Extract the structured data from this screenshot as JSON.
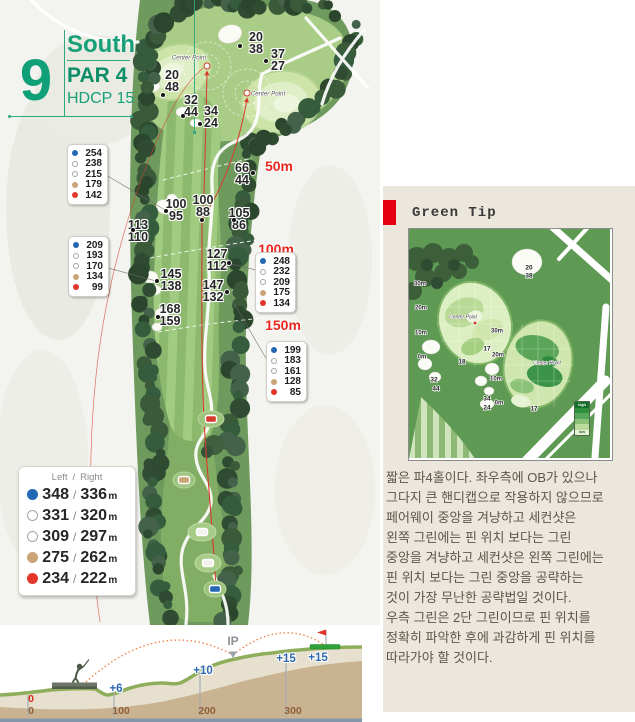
{
  "header": {
    "hole_number": "9",
    "course_name": "South",
    "par": "PAR 4",
    "hdcp": "HDCP 15"
  },
  "colors": {
    "accent_green": "#12A178",
    "marker_red": "#E8281E",
    "accent_red": "#E60012",
    "dot_blue": "#2268B2",
    "dot_tan": "#C9A477",
    "dot_red": "#E3372B",
    "panel_bg": "#ECE7DC",
    "elev_blue": "#2D68B0",
    "dist_brown": "#8F603A"
  },
  "map": {
    "center_point_label": "Center Point",
    "distance_markers": [
      {
        "label": "50m",
        "x": 279,
        "y": 166
      },
      {
        "label": "100m",
        "x": 276,
        "y": 249
      },
      {
        "label": "150m",
        "x": 283,
        "y": 325
      }
    ],
    "yardage_pairs": [
      {
        "top": "20",
        "bottom": "38",
        "x": 256,
        "y": 43,
        "dot_x": 240,
        "dot_y": 46
      },
      {
        "top": "37",
        "bottom": "27",
        "x": 278,
        "y": 60,
        "dot_x": 266,
        "dot_y": 61
      },
      {
        "top": "20",
        "bottom": "48",
        "x": 172,
        "y": 81,
        "dot_x": 163,
        "dot_y": 95
      },
      {
        "top": "32",
        "bottom": "44",
        "x": 191,
        "y": 106,
        "dot_x": 183,
        "dot_y": 116
      },
      {
        "top": "34",
        "bottom": "24",
        "x": 211,
        "y": 117,
        "dot_x": 200,
        "dot_y": 124
      },
      {
        "top": "66",
        "bottom": "44",
        "x": 242,
        "y": 174,
        "dot_x": 253,
        "dot_y": 173
      },
      {
        "top": "100",
        "bottom": "95",
        "x": 176,
        "y": 210,
        "dot_x": 166,
        "dot_y": 211
      },
      {
        "top": "100",
        "bottom": "88",
        "x": 203,
        "y": 206,
        "dot_x": 202,
        "dot_y": 220
      },
      {
        "top": "113",
        "bottom": "110",
        "x": 138,
        "y": 231,
        "dot_x": 133,
        "dot_y": 230
      },
      {
        "top": "105",
        "bottom": "86",
        "x": 239,
        "y": 219,
        "dot_x": 234,
        "dot_y": 220
      },
      {
        "top": "127",
        "bottom": "112",
        "x": 217,
        "y": 260,
        "dot_x": 229,
        "dot_y": 263
      },
      {
        "top": "145",
        "bottom": "138",
        "x": 171,
        "y": 280,
        "dot_x": 157,
        "dot_y": 281
      },
      {
        "top": "147",
        "bottom": "132",
        "x": 213,
        "y": 291,
        "dot_x": 227,
        "dot_y": 292
      },
      {
        "top": "168",
        "bottom": "159",
        "x": 170,
        "y": 315,
        "dot_x": 158,
        "dot_y": 317
      }
    ],
    "center_points": [
      {
        "label": "Center Point",
        "label_x": 189,
        "label_y": 58,
        "target_x": 207,
        "target_y": 66
      },
      {
        "label": "Center Point",
        "label_x": 268,
        "label_y": 94,
        "target_x": 247,
        "target_y": 93
      }
    ],
    "badges": [
      {
        "x": 67,
        "y": 144,
        "rows": [
          {
            "color": "blue",
            "value": "254"
          },
          {
            "color": "white",
            "value": "238"
          },
          {
            "color": "white",
            "value": "215"
          },
          {
            "color": "tan",
            "value": "179"
          },
          {
            "color": "red",
            "value": "142"
          }
        ]
      },
      {
        "x": 68,
        "y": 236,
        "rows": [
          {
            "color": "blue",
            "value": "209"
          },
          {
            "color": "white",
            "value": "193"
          },
          {
            "color": "white",
            "value": "170"
          },
          {
            "color": "tan",
            "value": "134"
          },
          {
            "color": "red",
            "value": "99"
          }
        ]
      },
      {
        "x": 255,
        "y": 252,
        "rows": [
          {
            "color": "blue",
            "value": "248"
          },
          {
            "color": "white",
            "value": "232"
          },
          {
            "color": "white",
            "value": "209"
          },
          {
            "color": "tan",
            "value": "175"
          },
          {
            "color": "red",
            "value": "134"
          }
        ]
      },
      {
        "x": 266,
        "y": 341,
        "rows": [
          {
            "color": "blue",
            "value": "199"
          },
          {
            "color": "white",
            "value": "183"
          },
          {
            "color": "white",
            "value": "161"
          },
          {
            "color": "tan",
            "value": "128"
          },
          {
            "color": "red",
            "value": "85"
          }
        ]
      }
    ],
    "legend": {
      "header_left": "Left",
      "header_sep": "/",
      "header_right": "Right",
      "unit": "m",
      "rows": [
        {
          "color": "blue",
          "left": "348",
          "right": "336"
        },
        {
          "color": "white",
          "left": "331",
          "right": "320"
        },
        {
          "color": "white",
          "left": "309",
          "right": "297"
        },
        {
          "color": "tan",
          "left": "275",
          "right": "262"
        },
        {
          "color": "red",
          "left": "234",
          "right": "222"
        }
      ]
    }
  },
  "green_tip": {
    "title": "Green Tip",
    "body": "짧은 파4홀이다. 좌우측에 OB가 있으나\n그다지 큰 핸디캡으로 작용하지 않으므로\n페어웨이 중앙을 겨냥하고 세컨샷은\n왼쪽 그린에는 핀 위치 보다는 그린\n중앙을 겨냥하고 세컨샷은 왼쪽 그린에는\n핀 위치 보다는 그린 중앙을 공략하는\n것이 가장 무난한 공략법일 것이다.\n우측 그린은 2단 그린이므로 핀 위치를\n정확히 파악한 후에 과감하게 핀 위치를\n따라가야 할 것이다.",
    "minimap": {
      "legend_high": "high",
      "legend_low": "low",
      "labels": [
        {
          "text": "30m",
          "x": 420,
          "y": 284,
          "cls": "mini-dist"
        },
        {
          "text": "20m",
          "x": 421,
          "y": 308,
          "cls": "mini-dist"
        },
        {
          "text": "10m",
          "x": 421,
          "y": 333,
          "cls": "mini-dist"
        },
        {
          "text": "0m",
          "x": 422,
          "y": 357,
          "cls": "mini-dist"
        },
        {
          "text": "30m",
          "x": 497,
          "y": 331,
          "cls": "mini-dist"
        },
        {
          "text": "20m",
          "x": 498,
          "y": 355,
          "cls": "mini-dist"
        },
        {
          "text": "10m",
          "x": 496,
          "y": 379,
          "cls": "mini-dist"
        },
        {
          "text": "0m",
          "x": 499,
          "y": 403,
          "cls": "mini-dist"
        },
        {
          "text": "20",
          "x": 529,
          "y": 268,
          "cls": "mini-num"
        },
        {
          "text": "38",
          "x": 529,
          "y": 276,
          "cls": "mini-num"
        },
        {
          "text": "17",
          "x": 487,
          "y": 349,
          "cls": "mini-num"
        },
        {
          "text": "18",
          "x": 462,
          "y": 362,
          "cls": "mini-num"
        },
        {
          "text": "32",
          "x": 434,
          "y": 380,
          "cls": "mini-num"
        },
        {
          "text": "44",
          "x": 436,
          "y": 389,
          "cls": "mini-num"
        },
        {
          "text": "34",
          "x": 487,
          "y": 399,
          "cls": "mini-num"
        },
        {
          "text": "24",
          "x": 487,
          "y": 408,
          "cls": "mini-num"
        },
        {
          "text": "17",
          "x": 534,
          "y": 409,
          "cls": "mini-num"
        },
        {
          "text": "Center Point",
          "x": 463,
          "y": 317,
          "cls": "mini-cp"
        },
        {
          "text": "Center Point",
          "x": 547,
          "y": 363,
          "cls": "mini-cp"
        }
      ]
    }
  },
  "profile": {
    "ip_label": "IP",
    "ip_x": 233,
    "ip_y": 641,
    "elevations": [
      {
        "label": "+6",
        "x": 116,
        "y": 689
      },
      {
        "label": "+10",
        "x": 203,
        "y": 671
      },
      {
        "label": "+15",
        "x": 286,
        "y": 659
      },
      {
        "label": "+15",
        "x": 318,
        "y": 658
      }
    ],
    "distances": [
      {
        "label": "0",
        "x": 31,
        "y": 699,
        "red": true
      },
      {
        "label": "0",
        "x": 31,
        "y": 711,
        "red": false
      },
      {
        "label": "100",
        "x": 121,
        "y": 711,
        "red": false
      },
      {
        "label": "200",
        "x": 207,
        "y": 711,
        "red": false
      },
      {
        "label": "300",
        "x": 293,
        "y": 711,
        "red": false
      }
    ]
  }
}
